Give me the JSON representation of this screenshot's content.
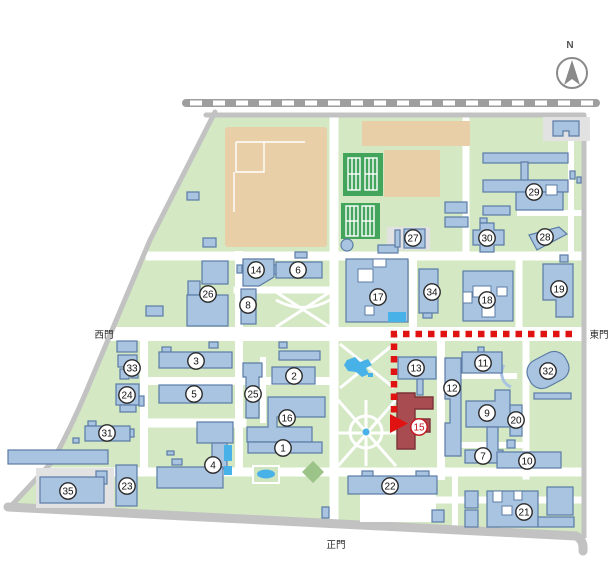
{
  "labels": {
    "west_gate": "西門",
    "east_gate": "東門",
    "main_gate": "正門",
    "compass_n": "N"
  },
  "colors": {
    "ground": "#d3e8c3",
    "building": "#a9c4e1",
    "building_border": "#5b7ca5",
    "target_building": "#a84c52",
    "route_red": "#e01212",
    "field_tan": "#e9cfa8",
    "tennis_green": "#43a45b",
    "water_blue": "#48b2e8",
    "road_gray": "#c2c2c2"
  },
  "route": {
    "description": "red dashed path from east gate to building 15",
    "target_badge": "15"
  },
  "badges": [
    {
      "n": "1",
      "x": 283,
      "y": 448
    },
    {
      "n": "2",
      "x": 294,
      "y": 376
    },
    {
      "n": "3",
      "x": 196,
      "y": 361
    },
    {
      "n": "4",
      "x": 213,
      "y": 465
    },
    {
      "n": "5",
      "x": 194,
      "y": 394
    },
    {
      "n": "6",
      "x": 298,
      "y": 270
    },
    {
      "n": "7",
      "x": 483,
      "y": 456
    },
    {
      "n": "8",
      "x": 248,
      "y": 305
    },
    {
      "n": "9",
      "x": 487,
      "y": 413
    },
    {
      "n": "10",
      "x": 527,
      "y": 461
    },
    {
      "n": "11",
      "x": 483,
      "y": 363
    },
    {
      "n": "12",
      "x": 452,
      "y": 388
    },
    {
      "n": "13",
      "x": 416,
      "y": 368
    },
    {
      "n": "14",
      "x": 256,
      "y": 270
    },
    {
      "n": "15",
      "x": 419,
      "y": 427,
      "target": true
    },
    {
      "n": "16",
      "x": 287,
      "y": 418
    },
    {
      "n": "17",
      "x": 378,
      "y": 297
    },
    {
      "n": "18",
      "x": 487,
      "y": 300
    },
    {
      "n": "19",
      "x": 559,
      "y": 289
    },
    {
      "n": "20",
      "x": 516,
      "y": 420
    },
    {
      "n": "21",
      "x": 524,
      "y": 512
    },
    {
      "n": "22",
      "x": 390,
      "y": 486
    },
    {
      "n": "23",
      "x": 127,
      "y": 486
    },
    {
      "n": "24",
      "x": 127,
      "y": 395
    },
    {
      "n": "25",
      "x": 253,
      "y": 394
    },
    {
      "n": "26",
      "x": 208,
      "y": 294
    },
    {
      "n": "27",
      "x": 413,
      "y": 238
    },
    {
      "n": "28",
      "x": 545,
      "y": 237
    },
    {
      "n": "29",
      "x": 534,
      "y": 192
    },
    {
      "n": "30",
      "x": 487,
      "y": 238
    },
    {
      "n": "31",
      "x": 107,
      "y": 433
    },
    {
      "n": "32",
      "x": 548,
      "y": 371
    },
    {
      "n": "33",
      "x": 132,
      "y": 368
    },
    {
      "n": "34",
      "x": 432,
      "y": 292
    },
    {
      "n": "35",
      "x": 68,
      "y": 491
    }
  ]
}
